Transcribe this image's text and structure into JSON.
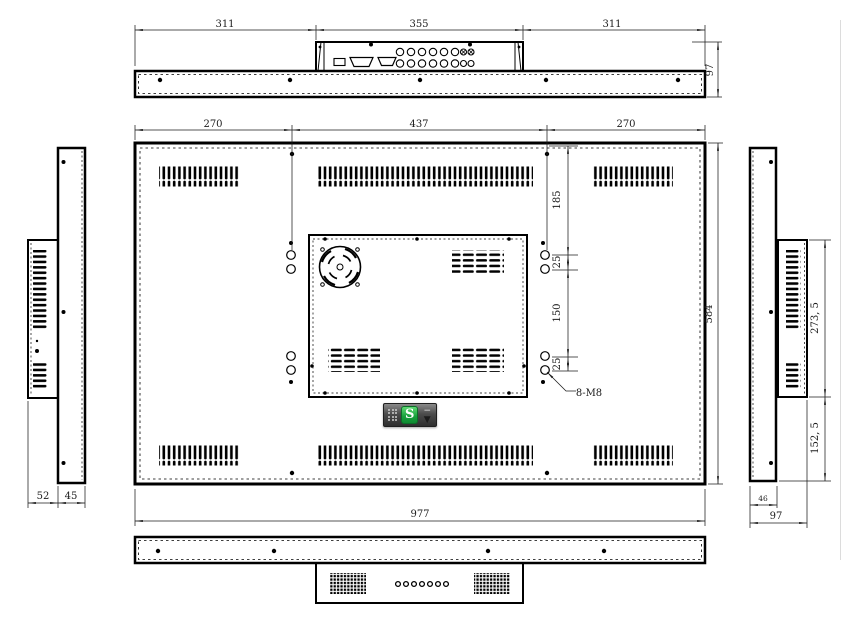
{
  "views": {
    "top": {
      "dim_left": "311",
      "dim_center": "355",
      "dim_right": "311",
      "dim_depth": "97"
    },
    "back": {
      "dim_top_left": "270",
      "dim_top_center": "437",
      "dim_top_right": "270",
      "dim_width": "977",
      "dim_height": "584",
      "dim_hole_top_offset": "185",
      "dim_hole_gap_top": "25",
      "dim_hole_span": "150",
      "dim_hole_gap_bottom": "25",
      "thread_label": "8-M8"
    },
    "left": {
      "dim_cover_depth": "52",
      "dim_body_depth": "45"
    },
    "right": {
      "dim_cover_height": "273, 5",
      "dim_lower_height": "152, 5",
      "dim_body_depth": "46",
      "dim_total_depth": "97"
    }
  },
  "overlay": {
    "ime_letter": "S",
    "minimize_glyph": "−",
    "expand_glyph": "▼"
  }
}
